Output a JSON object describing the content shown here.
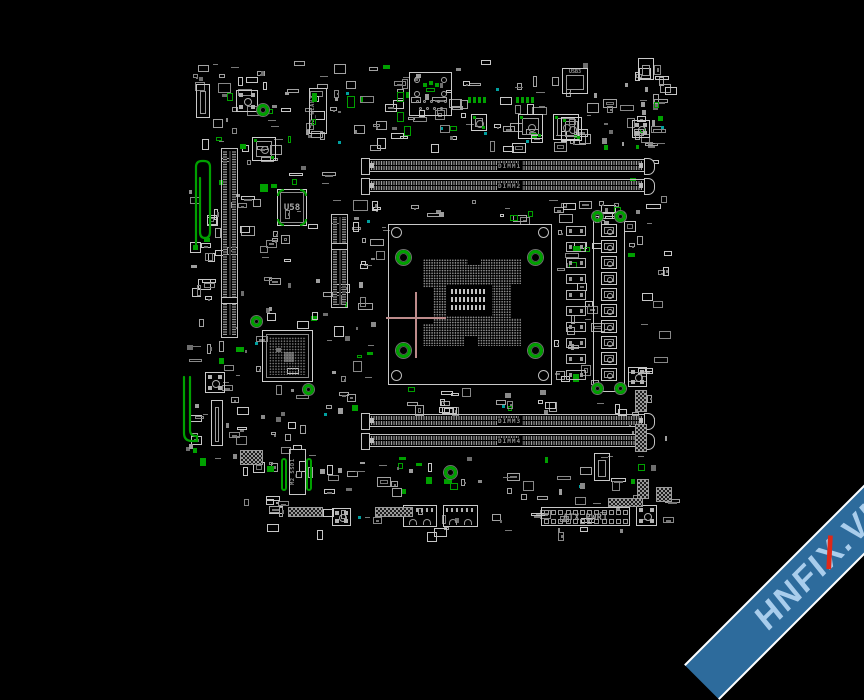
{
  "app": {
    "background": "#000000",
    "description": "motherboard boardview screen"
  },
  "palette": {
    "outline": "#c9c9c9",
    "outline_dim": "#9a9a9a",
    "fill": "#777777",
    "green": "#00a000",
    "cyan": "#00a0a0",
    "crosshair": "#bd8b8b",
    "label": "#8f8f8f"
  },
  "watermark": {
    "pre": "HNFI",
    "x_char": "X",
    "post": ".VN",
    "band_color": "#2d6b9c",
    "edge_color": "#ffffff",
    "text_color": "#a9cdec",
    "accent_color": "#e02818"
  },
  "labels": {
    "u58": "U58",
    "m2_wlan": "M2_WLAN1",
    "m2_ssd": "M2_SSD1",
    "atx": "ATX_PWR1",
    "usb3": "USB3",
    "dimm_slots": [
      "DIMM1",
      "DIMM2",
      "DIMM3",
      "DIMM4"
    ]
  },
  "components": [
    {
      "t": "rect",
      "n": "cpu-socket-outline",
      "x": 388,
      "y": 224,
      "w": 164,
      "h": 161,
      "i": true
    },
    {
      "t": "screw",
      "n": "socket-screw-tl",
      "x": 391,
      "y": 227,
      "w": 11,
      "h": 11
    },
    {
      "t": "screw",
      "n": "socket-screw-tr",
      "x": 538,
      "y": 227,
      "w": 11,
      "h": 11
    },
    {
      "t": "screw",
      "n": "socket-screw-bl",
      "x": 391,
      "y": 370,
      "w": 11,
      "h": 11
    },
    {
      "t": "screw",
      "n": "socket-screw-br",
      "x": 538,
      "y": 370,
      "w": 11,
      "h": 11
    },
    {
      "t": "pinfield",
      "n": "cpu-pin-array",
      "x": 423,
      "y": 259,
      "w": 98,
      "h": 87
    },
    {
      "t": "black",
      "n": "pin-notch",
      "x": 423,
      "y": 288,
      "w": 10,
      "h": 36
    },
    {
      "t": "black",
      "n": "pin-notch",
      "x": 511,
      "y": 284,
      "w": 10,
      "h": 34
    },
    {
      "t": "black",
      "n": "pin-notch",
      "x": 468,
      "y": 259,
      "w": 13,
      "h": 6
    },
    {
      "t": "black",
      "n": "pin-notch",
      "x": 464,
      "y": 336,
      "w": 14,
      "h": 10
    },
    {
      "t": "black",
      "n": "cpu-center-cavity",
      "x": 446,
      "y": 285,
      "w": 46,
      "h": 31
    },
    {
      "t": "padgrid",
      "n": "cpu-center-caps",
      "x": 451,
      "y": 289,
      "w": 36,
      "h": 24,
      "r": 3,
      "c": 9
    },
    {
      "t": "ring",
      "n": "socket-mount-hole",
      "x": 396,
      "y": 250,
      "w": 15,
      "h": 15
    },
    {
      "t": "ring",
      "n": "socket-mount-hole",
      "x": 528,
      "y": 250,
      "w": 15,
      "h": 15
    },
    {
      "t": "ring",
      "n": "socket-mount-hole",
      "x": 396,
      "y": 343,
      "w": 15,
      "h": 15
    },
    {
      "t": "ring",
      "n": "socket-mount-hole",
      "x": 528,
      "y": 343,
      "w": 15,
      "h": 15
    },
    {
      "t": "dimm",
      "n": "dimm-slot-1",
      "x": 368,
      "y": 159,
      "w": 277,
      "h": 13,
      "lidx": 0,
      "i": true
    },
    {
      "t": "dimm",
      "n": "dimm-slot-2",
      "x": 368,
      "y": 179,
      "w": 277,
      "h": 13,
      "lidx": 1,
      "i": true
    },
    {
      "t": "dimm",
      "n": "dimm-slot-3",
      "x": 368,
      "y": 414,
      "w": 277,
      "h": 13,
      "lidx": 2,
      "i": true
    },
    {
      "t": "dimm",
      "n": "dimm-slot-4",
      "x": 368,
      "y": 434,
      "w": 277,
      "h": 13,
      "lidx": 3,
      "i": true
    },
    {
      "t": "vslot",
      "n": "pcie-x16-slot",
      "x": 221,
      "y": 148,
      "w": 17,
      "h": 190,
      "k": 0.78,
      "i": true
    },
    {
      "t": "vslot",
      "n": "pcie-x4-slot",
      "x": 331,
      "y": 214,
      "w": 17,
      "h": 94,
      "k": 0.3,
      "i": true
    },
    {
      "t": "bga",
      "n": "chipset-bga",
      "x": 262,
      "y": 330,
      "w": 51,
      "h": 52,
      "i": true
    },
    {
      "t": "ring",
      "n": "chipset-mount-hole",
      "x": 251,
      "y": 316,
      "w": 11,
      "h": 11
    },
    {
      "t": "ring",
      "n": "chipset-mount-hole",
      "x": 303,
      "y": 384,
      "w": 11,
      "h": 11
    },
    {
      "t": "icbig",
      "n": "chip-u58",
      "x": 277,
      "y": 189,
      "w": 30,
      "h": 37,
      "lkey": "u58",
      "i": true
    },
    {
      "t": "gfill",
      "n": "highlight",
      "x": 271,
      "y": 184,
      "w": 6,
      "h": 4
    },
    {
      "t": "mslot",
      "n": "m2-wlan-slot",
      "x": 309,
      "y": 88,
      "w": 18,
      "h": 46,
      "lkey": "m2_wlan",
      "g": true,
      "i": true
    },
    {
      "t": "mslot",
      "n": "m2-ssd-slot",
      "x": 289,
      "y": 449,
      "w": 17,
      "h": 46,
      "lkey": "m2_ssd",
      "i": true
    },
    {
      "t": "gbar",
      "n": "m2-standoff",
      "x": 281,
      "y": 458,
      "w": 6,
      "h": 33
    },
    {
      "t": "gbar",
      "n": "m2-standoff",
      "x": 306,
      "y": 458,
      "w": 6,
      "h": 33
    },
    {
      "t": "rect",
      "n": "vrm-outline",
      "x": 593,
      "y": 212,
      "w": 32,
      "h": 180,
      "i": true
    },
    {
      "t": "ring",
      "n": "vrm-mount-hole",
      "x": 592,
      "y": 211,
      "w": 11,
      "h": 11
    },
    {
      "t": "ring",
      "n": "vrm-mount-hole",
      "x": 615,
      "y": 211,
      "w": 11,
      "h": 11
    },
    {
      "t": "ring",
      "n": "vrm-mount-hole",
      "x": 592,
      "y": 383,
      "w": 11,
      "h": 11
    },
    {
      "t": "ring",
      "n": "vrm-mount-hole",
      "x": 615,
      "y": 383,
      "w": 11,
      "h": 11
    },
    {
      "t": "choke",
      "n": "vrm-choke",
      "x": 601,
      "y": 224,
      "w": 16,
      "h": 13,
      "i": true
    },
    {
      "t": "choke",
      "n": "vrm-choke",
      "x": 601,
      "y": 240,
      "w": 16,
      "h": 13,
      "i": true
    },
    {
      "t": "choke",
      "n": "vrm-choke",
      "x": 601,
      "y": 256,
      "w": 16,
      "h": 13,
      "i": true
    },
    {
      "t": "choke",
      "n": "vrm-choke",
      "x": 601,
      "y": 272,
      "w": 16,
      "h": 13,
      "i": true
    },
    {
      "t": "choke",
      "n": "vrm-choke",
      "x": 601,
      "y": 288,
      "w": 16,
      "h": 13,
      "i": true
    },
    {
      "t": "choke",
      "n": "vrm-choke",
      "x": 601,
      "y": 304,
      "w": 16,
      "h": 13,
      "i": true
    },
    {
      "t": "choke",
      "n": "vrm-choke",
      "x": 601,
      "y": 320,
      "w": 16,
      "h": 13,
      "i": true
    },
    {
      "t": "choke",
      "n": "vrm-choke",
      "x": 601,
      "y": 336,
      "w": 16,
      "h": 13,
      "i": true
    },
    {
      "t": "choke",
      "n": "vrm-choke",
      "x": 601,
      "y": 352,
      "w": 16,
      "h": 13,
      "i": true
    },
    {
      "t": "choke",
      "n": "vrm-choke",
      "x": 601,
      "y": 368,
      "w": 16,
      "h": 13,
      "i": true
    },
    {
      "t": "chip2",
      "n": "vrm-mosfet",
      "x": 566,
      "y": 226,
      "w": 20,
      "h": 10
    },
    {
      "t": "chip2",
      "n": "vrm-mosfet",
      "x": 566,
      "y": 242,
      "w": 20,
      "h": 10
    },
    {
      "t": "chip2",
      "n": "vrm-mosfet",
      "x": 566,
      "y": 258,
      "w": 20,
      "h": 10
    },
    {
      "t": "chip2",
      "n": "vrm-mosfet",
      "x": 566,
      "y": 274,
      "w": 20,
      "h": 10
    },
    {
      "t": "chip2",
      "n": "vrm-mosfet",
      "x": 566,
      "y": 290,
      "w": 20,
      "h": 10
    },
    {
      "t": "chip2",
      "n": "vrm-mosfet",
      "x": 566,
      "y": 306,
      "w": 20,
      "h": 10
    },
    {
      "t": "chip2",
      "n": "vrm-mosfet",
      "x": 566,
      "y": 322,
      "w": 20,
      "h": 10
    },
    {
      "t": "chip2",
      "n": "vrm-mosfet",
      "x": 566,
      "y": 338,
      "w": 20,
      "h": 10
    },
    {
      "t": "chip2",
      "n": "vrm-mosfet",
      "x": 566,
      "y": 354,
      "w": 20,
      "h": 10
    },
    {
      "t": "chip2",
      "n": "vrm-mosfet",
      "x": 566,
      "y": 370,
      "w": 20,
      "h": 10
    },
    {
      "t": "atx",
      "n": "atx-power-connector",
      "x": 541,
      "y": 507,
      "w": 89,
      "h": 19,
      "lkey": "atx",
      "i": true
    },
    {
      "t": "padsq",
      "n": "pad-square",
      "x": 236,
      "y": 90,
      "w": 22,
      "h": 22
    },
    {
      "t": "padsq",
      "n": "pad-square",
      "x": 632,
      "y": 120,
      "w": 18,
      "h": 18
    },
    {
      "t": "padsq",
      "n": "pad-square",
      "x": 205,
      "y": 372,
      "w": 20,
      "h": 21
    },
    {
      "t": "padsq",
      "n": "pad-square",
      "x": 332,
      "y": 508,
      "w": 19,
      "h": 18
    },
    {
      "t": "padsq",
      "n": "pad-square",
      "x": 628,
      "y": 367,
      "w": 19,
      "h": 20
    },
    {
      "t": "padsq",
      "n": "pad-square",
      "x": 636,
      "y": 505,
      "w": 21,
      "h": 21
    },
    {
      "t": "ictarget",
      "n": "ic-chip",
      "x": 518,
      "y": 114,
      "w": 25,
      "h": 25,
      "i": true
    },
    {
      "t": "ictarget",
      "n": "ic-chip",
      "x": 553,
      "y": 114,
      "w": 26,
      "h": 26,
      "i": true
    },
    {
      "t": "ictarget",
      "n": "ic-chip",
      "x": 252,
      "y": 137,
      "w": 24,
      "h": 24,
      "i": true
    },
    {
      "t": "ictarget",
      "n": "ic-chip",
      "x": 471,
      "y": 114,
      "w": 16,
      "h": 17,
      "i": true
    },
    {
      "t": "ictarget",
      "n": "ic-chip",
      "x": 561,
      "y": 117,
      "w": 21,
      "h": 24,
      "i": true
    },
    {
      "t": "boxin",
      "n": "usb3-header",
      "x": 562,
      "y": 68,
      "w": 26,
      "h": 26,
      "lkey": "usb3",
      "i": true
    },
    {
      "t": "boxin",
      "n": "connector",
      "x": 638,
      "y": 58,
      "w": 16,
      "h": 22,
      "i": true
    },
    {
      "t": "boxin",
      "n": "connector",
      "x": 196,
      "y": 84,
      "w": 14,
      "h": 34,
      "i": true
    },
    {
      "t": "boxin",
      "n": "connector",
      "x": 211,
      "y": 400,
      "w": 12,
      "h": 46,
      "i": true
    },
    {
      "t": "boxin",
      "n": "connector",
      "x": 594,
      "y": 453,
      "w": 16,
      "h": 28,
      "i": true
    },
    {
      "t": "audio",
      "n": "audio-jack-connector",
      "x": 409,
      "y": 72,
      "w": 43,
      "h": 44,
      "i": true
    },
    {
      "t": "port",
      "n": "usb-port",
      "x": 403,
      "y": 505,
      "w": 34,
      "h": 22,
      "i": true
    },
    {
      "t": "port",
      "n": "usb-port",
      "x": 443,
      "y": 505,
      "w": 35,
      "h": 22,
      "i": true
    },
    {
      "t": "headerh",
      "n": "front-panel-header",
      "x": 288,
      "y": 507,
      "w": 35,
      "h": 10,
      "i": true
    },
    {
      "t": "headerh",
      "n": "front-panel-header",
      "x": 375,
      "y": 507,
      "w": 38,
      "h": 10,
      "i": true
    },
    {
      "t": "headerh",
      "n": "front-panel-header",
      "x": 608,
      "y": 498,
      "w": 35,
      "h": 9,
      "i": true
    },
    {
      "t": "headerh",
      "n": "front-panel-header",
      "x": 240,
      "y": 450,
      "w": 23,
      "h": 15,
      "i": true
    },
    {
      "t": "headerv",
      "n": "side-header",
      "x": 635,
      "y": 390,
      "w": 12,
      "h": 22,
      "i": true
    },
    {
      "t": "headerv",
      "n": "side-header",
      "x": 635,
      "y": 424,
      "w": 12,
      "h": 28,
      "i": true
    },
    {
      "t": "headerv",
      "n": "side-header",
      "x": 637,
      "y": 479,
      "w": 12,
      "h": 20,
      "i": true
    },
    {
      "t": "headerh",
      "n": "side-header",
      "x": 656,
      "y": 487,
      "w": 16,
      "h": 15,
      "i": true
    },
    {
      "t": "ring",
      "n": "mount-hole",
      "x": 257,
      "y": 104,
      "w": 12,
      "h": 12
    },
    {
      "t": "ring",
      "n": "mount-hole",
      "x": 444,
      "y": 466,
      "w": 13,
      "h": 13
    },
    {
      "t": "gpads",
      "n": "highlight-pads",
      "x": 468,
      "y": 97,
      "w": 18,
      "h": 6
    },
    {
      "t": "gpads",
      "n": "highlight-pads",
      "x": 516,
      "y": 97,
      "w": 18,
      "h": 6
    },
    {
      "t": "grect",
      "n": "highlight",
      "x": 397,
      "y": 92,
      "w": 7,
      "h": 10
    },
    {
      "t": "grect",
      "n": "highlight",
      "x": 397,
      "y": 112,
      "w": 7,
      "h": 10
    },
    {
      "t": "grect",
      "n": "highlight",
      "x": 404,
      "y": 126,
      "w": 7,
      "h": 10
    },
    {
      "t": "grect",
      "n": "highlight",
      "x": 347,
      "y": 96,
      "w": 8,
      "h": 12
    },
    {
      "t": "gfill",
      "n": "highlight",
      "x": 658,
      "y": 116,
      "w": 5,
      "h": 5
    },
    {
      "t": "rect",
      "n": "antenna-pad",
      "x": 190,
      "y": 242,
      "w": 11,
      "h": 11
    },
    {
      "t": "gfill",
      "n": "highlight",
      "x": 193,
      "y": 245,
      "w": 5,
      "h": 5
    },
    {
      "t": "hline",
      "n": "crosshair-h",
      "x": 386,
      "y": 317,
      "w": 60,
      "h": 2
    },
    {
      "t": "vline",
      "n": "crosshair-v",
      "x": 415,
      "y": 292,
      "w": 2,
      "h": 66
    }
  ],
  "green_traces": [
    {
      "n": "highlighted-trace-loop",
      "d": "M196,246 L196,167 Q196,161 202,161 L204,161 Q210,161 210,167 L210,232 Q210,238 205,238 Q200,238 200,232 L200,178"
    },
    {
      "n": "highlighted-trace-bar",
      "d": "M184,377 L184,433 Q184,441 192,441 L197,441 L197,436 Q190,436 190,430 L190,377"
    }
  ],
  "scatter": {
    "seed": 7,
    "regions": [
      {
        "x": 192,
        "y": 60,
        "w": 470,
        "h": 86,
        "n": 170
      },
      {
        "x": 185,
        "y": 152,
        "w": 140,
        "h": 176,
        "n": 60
      },
      {
        "x": 185,
        "y": 332,
        "w": 142,
        "h": 136,
        "n": 55
      },
      {
        "x": 318,
        "y": 200,
        "w": 66,
        "h": 182,
        "n": 36
      },
      {
        "x": 352,
        "y": 198,
        "w": 308,
        "h": 24,
        "n": 28
      },
      {
        "x": 554,
        "y": 202,
        "w": 44,
        "h": 186,
        "n": 30
      },
      {
        "x": 330,
        "y": 387,
        "w": 332,
        "h": 26,
        "n": 30
      },
      {
        "x": 230,
        "y": 452,
        "w": 402,
        "h": 80,
        "n": 85
      },
      {
        "x": 628,
        "y": 62,
        "w": 38,
        "h": 468,
        "n": 45
      }
    ]
  }
}
